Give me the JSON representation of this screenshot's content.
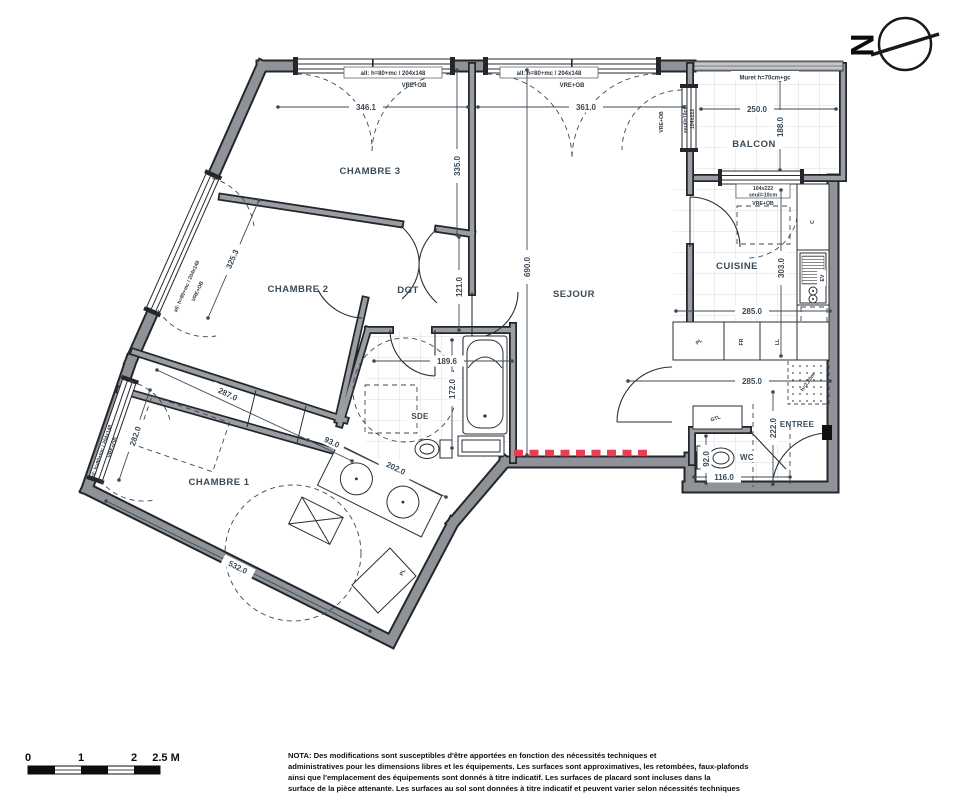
{
  "meta": {
    "wall_color": "#8f9397",
    "line_color": "#23272c",
    "text_color": "#3b4a57",
    "radiator_color": "#ee3a52",
    "background": "#ffffff"
  },
  "rooms": {
    "chambre1": "CHAMBRE 1",
    "chambre2": "CHAMBRE 2",
    "chambre3": "CHAMBRE 3",
    "sejour": "SEJOUR",
    "cuisine": "CUISINE",
    "balcon": "BALCON",
    "sde": "SDE",
    "wc": "WC",
    "entree": "ENTREE",
    "dgt": "DGT"
  },
  "labels": {
    "window_spec": "all: h=80+mc / 204x148",
    "vre_ob": "VRE+OB",
    "muret": "Muret h=70cm+gc",
    "win_size": "104x222",
    "seuil": "seuil=10cm",
    "pl": "PL",
    "fr": "FR",
    "ll": "LL",
    "gtl": "GTL",
    "c": "C",
    "ev": "EV",
    "tri": "TRI",
    "fx": "h=2,20m"
  },
  "dims": {
    "d346": "346.1",
    "d361": "361.0",
    "d335": "335.0",
    "d690": "690.0",
    "d121": "121.0",
    "d325": "325.3",
    "d287": "287.0",
    "d93": "93.0",
    "d282": "282.0",
    "d532": "532.0",
    "d1896": "189.6",
    "d172": "172.0",
    "d202": "202.0",
    "d250": "250.0",
    "d188": "188.0",
    "d303": "303.0",
    "d285": "285.0",
    "d222": "222.0",
    "d92": "92.0",
    "d116": "116.0"
  },
  "north": {
    "letter": "N"
  },
  "scale_bar": {
    "t0": "0",
    "t1": "1",
    "t2": "2",
    "t25": "2.5 M"
  },
  "nota": {
    "l1": "NOTA: Des modifications sont susceptibles d'être apportées en fonction des nécessités techniques et",
    "l2": "administratives pour les dimensions libres et les équipements. Les surfaces sont approximatives, les retombées, faux-plafonds",
    "l3": "ainsi que l'emplacement des équipements sont donnés à titre indicatif. Les surfaces de placard sont incluses dans la",
    "l4": "surface de la pièce attenante. Les surfaces au sol sont données à titre indicatif et peuvent varier selon nécessités techniques"
  }
}
